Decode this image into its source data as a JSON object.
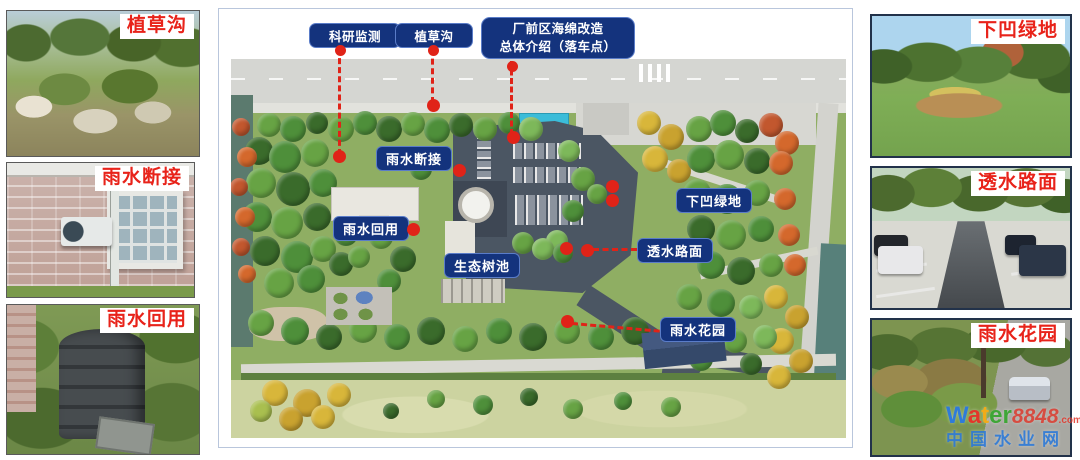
{
  "figure": {
    "left_photos": [
      {
        "id": "grass-swale",
        "label": "植草沟"
      },
      {
        "id": "downspout-disconnect",
        "label": "雨水断接"
      },
      {
        "id": "rainwater-reuse",
        "label": "雨水回用"
      }
    ],
    "right_photos": [
      {
        "id": "sunken-green",
        "label": "下凹绿地"
      },
      {
        "id": "permeable-pavement",
        "label": "透水路面"
      },
      {
        "id": "rain-garden",
        "label": "雨水花园"
      }
    ],
    "callouts": [
      {
        "label": "科研监测"
      },
      {
        "label": "植草沟"
      },
      {
        "line1": "厂前区海绵改造",
        "line2": "总体介绍（落车点）"
      }
    ],
    "map_labels": [
      {
        "label": "雨水断接"
      },
      {
        "label": "雨水回用"
      },
      {
        "label": "生态树池"
      },
      {
        "label": "下凹绿地"
      },
      {
        "label": "透水路面"
      },
      {
        "label": "雨水花园"
      }
    ],
    "colors": {
      "label_box_bg": "#14337d",
      "label_box_border": "#5a7cc8",
      "photo_label_red": "#e8231a",
      "marker_red": "#e02318",
      "panel_border": "#b9c6dc"
    }
  },
  "watermark": {
    "brand_letters": [
      {
        "ch": "W",
        "color": "#2f7bd9"
      },
      {
        "ch": "a",
        "color": "#e2362a"
      },
      {
        "ch": "t",
        "color": "#f2ab17"
      },
      {
        "ch": "e",
        "color": "#3fa637"
      },
      {
        "ch": "r",
        "color": "#3fa637"
      }
    ],
    "number": "8848",
    "number_color": "#e2362a",
    "tld": ".com",
    "tld_color": "#e2362a",
    "line2": "中国水业网",
    "line2_color": "#2f7bd9"
  }
}
